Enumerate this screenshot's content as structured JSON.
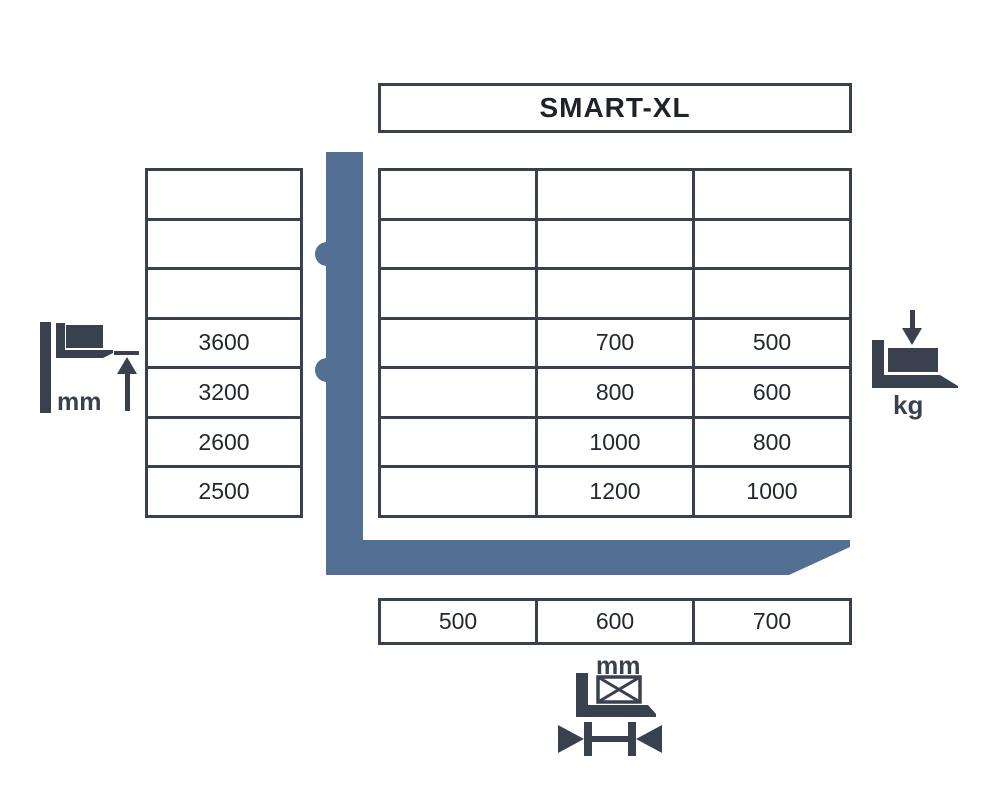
{
  "title": "SMART-XL",
  "colors": {
    "accent_blue": "#546F94",
    "dark": "#3A414E",
    "text": "#23272F"
  },
  "left_table": {
    "rows": [
      "",
      "",
      "",
      "3600",
      "3200",
      "2600",
      "2500"
    ]
  },
  "main_table": {
    "rows": [
      [
        "",
        "",
        ""
      ],
      [
        "",
        "",
        ""
      ],
      [
        "",
        "",
        ""
      ],
      [
        "",
        "700",
        "500"
      ],
      [
        "",
        "800",
        "600"
      ],
      [
        "",
        "1000",
        "800"
      ],
      [
        "",
        "1200",
        "1000"
      ]
    ]
  },
  "bottom_table": {
    "cells": [
      "500",
      "600",
      "700"
    ]
  },
  "icons": {
    "lift_height": {
      "label": "mm"
    },
    "capacity": {
      "label": "kg"
    },
    "load_width": {
      "label": "mm"
    }
  }
}
